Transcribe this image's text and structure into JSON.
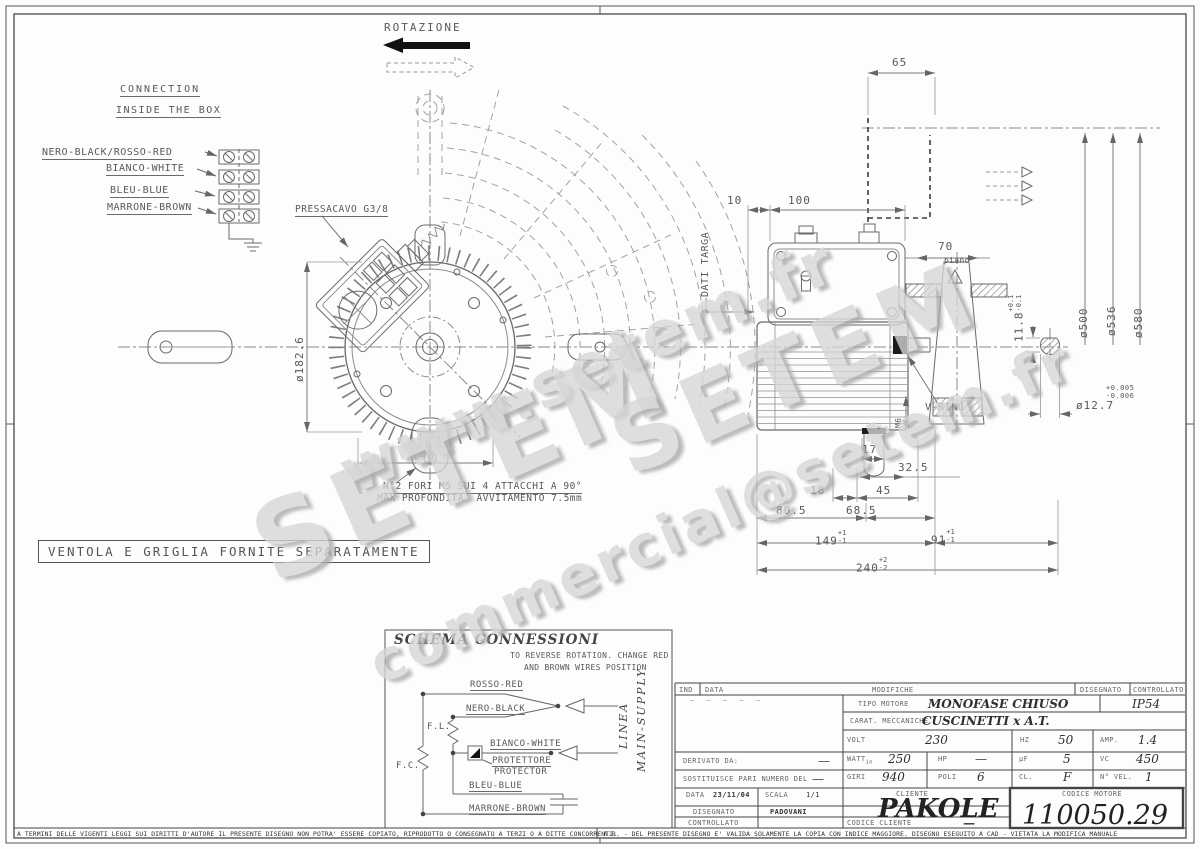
{
  "rotation_label": "ROTAZIONE",
  "connection_box": {
    "title1": "CONNECTION",
    "title2": "INSIDE THE BOX",
    "wire1": "NERO-BLACK/ROSSO-RED",
    "wire2": "BIANCO-WHITE",
    "wire3": "BLEU-BLUE",
    "wire4": "MARRONE-BROWN"
  },
  "front_view": {
    "pressacavo_label": "PRESSACAVO G3/8",
    "diameter": "ø182.6",
    "width_dim": "146",
    "hole_note1": "N°2 FORI M5 SUI 4 ATTACCHI A 90°",
    "hole_note2": "MAX PROFONDITA' AVVITAMENTO 7.5mm"
  },
  "separate_note": "VENTOLA E GRIGLIA FORNITE SEPARATAMENTE",
  "side_view": {
    "dim_65": "65",
    "dim_10": "10",
    "dim_100": "100",
    "dim_70": "70",
    "piano": "piano",
    "dati_targa": "DATI TARGA",
    "dim_11_8": "11.8",
    "tol_11_8_plus": "+0.1",
    "tol_11_8_minus": "-0.1",
    "dia_500": "ø500",
    "dia_536": "ø536",
    "dia_580": "ø580",
    "dia_12_7": "ø12.7",
    "tol_12_7_plus": "+0.005",
    "tol_12_7_minus": "-0.006",
    "v_ring": "V-RING",
    "m6": "M6",
    "dim_17": "17",
    "dim_32_5": "32.5",
    "dim_18": "18",
    "dim_45": "45",
    "dim_80_5": "80.5",
    "dim_68_5": "68.5",
    "dim_149": "149",
    "tol_149_plus": "+1",
    "tol_149_minus": "-1",
    "dim_91": "91",
    "tol_91_plus": "+1",
    "tol_91_minus": "-1",
    "dim_240": "240",
    "tol_240_plus": "+2",
    "tol_240_minus": "-2"
  },
  "schema": {
    "title": "SCHEMA CONNESSIONI",
    "note1": "TO REVERSE ROTATION. CHANGE RED",
    "note2": "AND BROWN WIRES POSITION",
    "rosso": "ROSSO-RED",
    "nero": "NERO-BLACK",
    "bianco": "BIANCO-WHITE",
    "protettore": "PROTETTORE",
    "protector": "PROTECTOR",
    "bleu": "BLEU-BLUE",
    "marrone": "MARRONE-BROWN",
    "fl": "F.L.",
    "fc": "F.C.",
    "linea": "LINEA",
    "main_supply": "MAIN-SUPPLY"
  },
  "title_block": {
    "ind": "IND",
    "data_h": "DATA",
    "modifiche": "MODIFICHE",
    "disegnato_h": "DISEGNATO",
    "controllato_h": "CONTROLLATO",
    "rev_dashes": "—   —   —   —   —",
    "tipo_motore": "TIPO MOTORE",
    "tipo_motore_val": "MONOFASE CHIUSO",
    "ip_val": "IP54",
    "carat": "CARAT. MECCANICHE",
    "carat_val": "CUSCINETTI x A.T.",
    "volt": "VOLT",
    "volt_val": "230",
    "hz": "HZ",
    "hz_val": "50",
    "amp": "AMP.",
    "amp_val": "1.4",
    "derivato": "DERIVATO DA:",
    "derivato_val": "—",
    "watt": "WATT",
    "watt_sub": "in",
    "watt_val": "250",
    "hp": "HP",
    "hp_val": "—",
    "uf": "µF",
    "uf_val": "5",
    "vc": "VC",
    "vc_val": "450",
    "sostituisce": "SOSTITUISCE PARI NUMERO DEL",
    "sostituisce_val": "—",
    "giri": "GIRI",
    "giri_val": "940",
    "poli": "POLI",
    "poli_val": "6",
    "cl": "CL.",
    "cl_val": "F",
    "nvel": "N° VEL.",
    "nvel_val": "1",
    "data_label": "DATA",
    "data_val": "23/11/04",
    "scala": "SCALA",
    "scala_val": "1/1",
    "cliente": "CLIENTE",
    "cliente_val": "PAKOLE",
    "codice_motore": "CODICE MOTORE",
    "codice_motore_val": "110050.29",
    "disegnato": "DISEGNATO",
    "disegnato_val": "PADOVANI",
    "controllato": "CONTROLLATO",
    "codice_cliente": "CODICE CLIENTE",
    "codice_cliente_val": "—"
  },
  "footer": {
    "left": "A TERMINI DELLE VIGENTI LEGGI SUI DIRITTI D'AUTORE IL PRESENTE DISEGNO NON POTRA' ESSERE COPIATO, RIPRODOTTO O CONSEGNATO A TERZI O A DITTE CONCORRENTI.",
    "right": "N.B. - DEL PRESENTE DISEGNO E' VALIDA SOLAMENTE LA COPIA CON INDICE MAGGIORE.    DISEGNO ESEGUITO A CAD - VIETATA LA MODIFICA MANUALE"
  },
  "watermarks": {
    "url": "www.setem.fr",
    "brand1": "SETEM",
    "brand2": "SETEM",
    "email": "commercial@setem.fr"
  }
}
